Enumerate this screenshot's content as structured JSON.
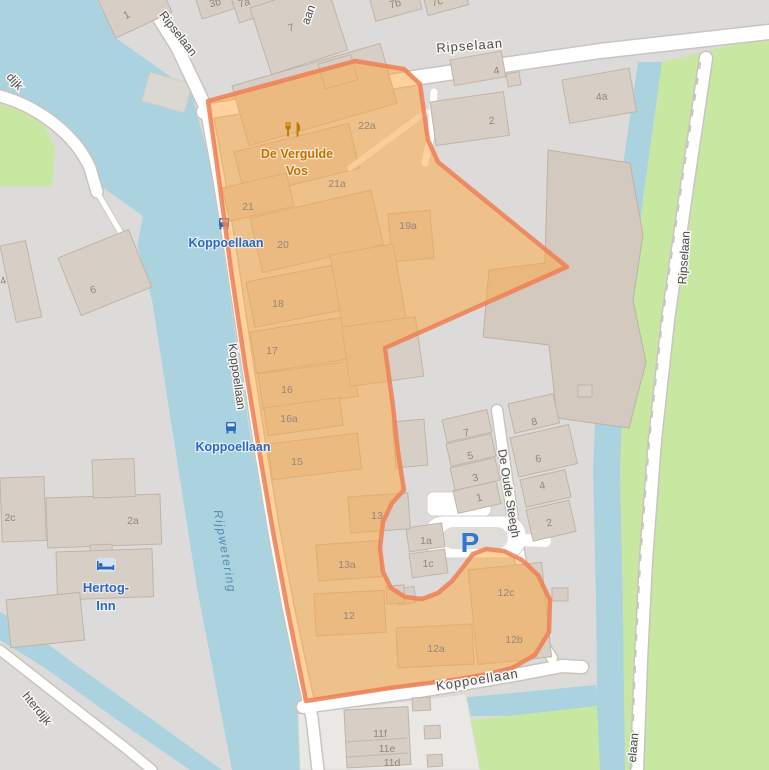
{
  "streets": {
    "ripselaan": "Ripselaan",
    "koppoellaan": "Koppoellaan",
    "de_oude_steegh": "De Oude Steegh",
    "fragment_aan": "aan",
    "fragment_dijk": "dijk",
    "fragment_hterdijk": "hterdijk",
    "fragment_elaan": "elaan"
  },
  "water_label": "Rijpwetering",
  "pois": {
    "restaurant_line1": "De Vergulde",
    "restaurant_line2": "Vos",
    "hotel_line1": "Hertog-",
    "hotel_line2": "Inn",
    "bus_stop_name": "Koppoellaan",
    "parking_symbol": "P"
  },
  "housenumbers": [
    "1",
    "3b",
    "7a",
    "7",
    "7b",
    "7c",
    "4",
    "4a",
    "2",
    "22a",
    "21a",
    "21",
    "20",
    "19a",
    "6",
    "18",
    "17",
    "16",
    "16a",
    "15",
    "13",
    "13a",
    "12",
    "2c",
    "2a",
    "7",
    "5",
    "3",
    "1",
    "8",
    "6",
    "4",
    "2",
    "1a",
    "1c",
    "12c",
    "12b",
    "12a",
    "11f",
    "11e",
    "11d",
    "4"
  ],
  "palette": {
    "water": "#aad3df",
    "grass": "#c8e8a2",
    "land": "#dcdbd9",
    "building": "#d7cec5",
    "road": "#ffffff",
    "highlight_fill": "#ffa53c",
    "highlight_stroke": "#ef7f55",
    "transit_blue": "#2c69c4",
    "amenity_amber": "#c07400",
    "street_text": "#4d4d4d",
    "housenumber_text": "#95867a",
    "water_text": "#5a8ab2"
  }
}
